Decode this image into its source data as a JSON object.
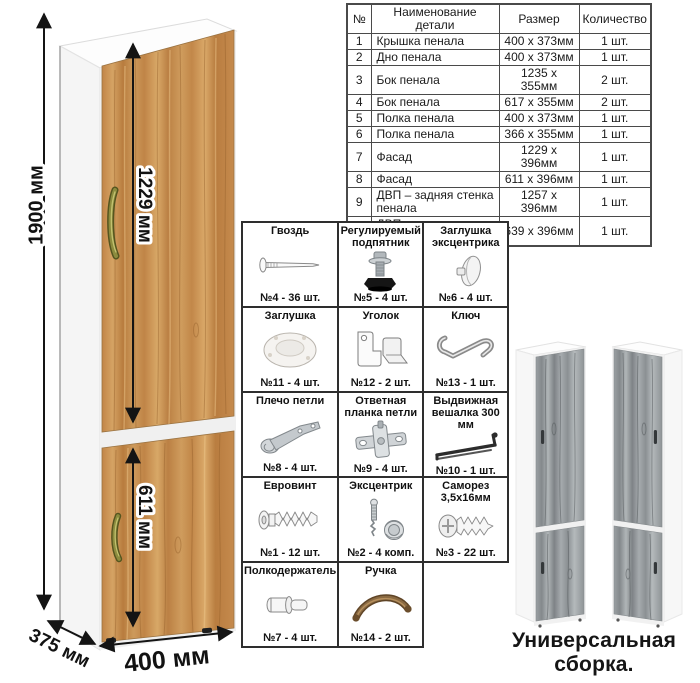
{
  "parts_table": {
    "headers": [
      "№",
      "Наименование детали",
      "Размер",
      "Количество"
    ],
    "rows": [
      [
        "1",
        "Крышка пенала",
        "400 х 373мм",
        "1 шт."
      ],
      [
        "2",
        "Дно пенала",
        "400 х 373мм",
        "1 шт."
      ],
      [
        "3",
        "Бок пенала",
        "1235 х 355мм",
        "2 шт."
      ],
      [
        "4",
        "Бок пенала",
        "617 х 355мм",
        "2 шт."
      ],
      [
        "5",
        "Полка пенала",
        "400 х 373мм",
        "1 шт."
      ],
      [
        "6",
        "Полка пенала",
        "366 х 355мм",
        "1 шт."
      ],
      [
        "7",
        "Фасад",
        "1229 х 396мм",
        "1 шт."
      ],
      [
        "8",
        "Фасад",
        "611 х 396мм",
        "1 шт."
      ],
      [
        "9",
        "ДВП – задняя стенка пенала",
        "1257 х 396мм",
        "1 шт."
      ],
      [
        "10",
        "ДВП – задняя стенка пенала",
        "639 х 396мм",
        "1 шт."
      ]
    ]
  },
  "dimensions": {
    "height": "1900 мм",
    "upper_door": "1229 мм",
    "lower_door": "611 мм",
    "depth": "375 мм",
    "width": "400 мм"
  },
  "hardware": {
    "items": [
      {
        "title": "Гвоздь",
        "count": "№4 - 36 шт."
      },
      {
        "title": "Регулируемый подпятник",
        "count": "№5 - 4 шт."
      },
      {
        "title": "Заглушка эксцентрика",
        "count": "№6 - 4 шт."
      },
      {
        "title": "Заглушка",
        "count": "№11 - 4 шт."
      },
      {
        "title": "Уголок",
        "count": "№12 - 2 шт."
      },
      {
        "title": "Ключ",
        "count": "№13 - 1 шт."
      },
      {
        "title": "Плечо петли",
        "count": "№8 - 4 шт."
      },
      {
        "title": "Ответная планка петли",
        "count": "№9 - 4 шт."
      },
      {
        "title": "Выдвижная вешалка 300 мм",
        "count": "№10 - 1 шт."
      },
      {
        "title": "Евровинт",
        "count": "№1 - 12 шт."
      },
      {
        "title": "Эксцентрик",
        "count": "№2 - 4 комп."
      },
      {
        "title": "Саморез 3,5х16мм",
        "count": "№3 - 22 шт."
      },
      {
        "title": "Полкодержатель",
        "count": "№7 - 4 шт."
      },
      {
        "title": "Ручка",
        "count": "№14 - 2 шт."
      }
    ]
  },
  "caption": "Универсальная сборка.",
  "colors": {
    "oak_wood": "#c68c4e",
    "gray_wood": "#9aa0a3",
    "carcass_white": "#ffffff",
    "dimension_line": "#141414"
  }
}
